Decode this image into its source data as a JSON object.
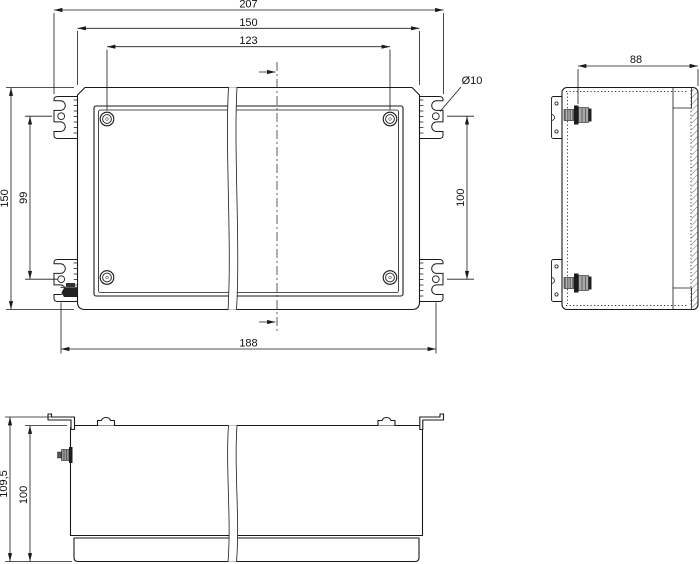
{
  "drawing": {
    "type": "technical dimensional drawing",
    "subject": "wall-mount enclosure with mounting brackets, three orthographic views",
    "colors": {
      "line": "#1a1a1a",
      "background": "#ffffff"
    },
    "front_view": {
      "dims": {
        "overall_width": "207",
        "body_width": "150",
        "cover_screw_spacing": "123",
        "overall_height": "150",
        "bracket_hole_spacing_left": "99",
        "bracket_hole_diameter": "Ø10",
        "bracket_hole_spacing_right": "100",
        "bracket_hole_spacing_horizontal": "188"
      }
    },
    "side_view": {
      "dims": {
        "depth": "88"
      }
    },
    "bottom_view": {
      "dims": {
        "overall_height": "109,5",
        "body_height": "100"
      }
    }
  }
}
